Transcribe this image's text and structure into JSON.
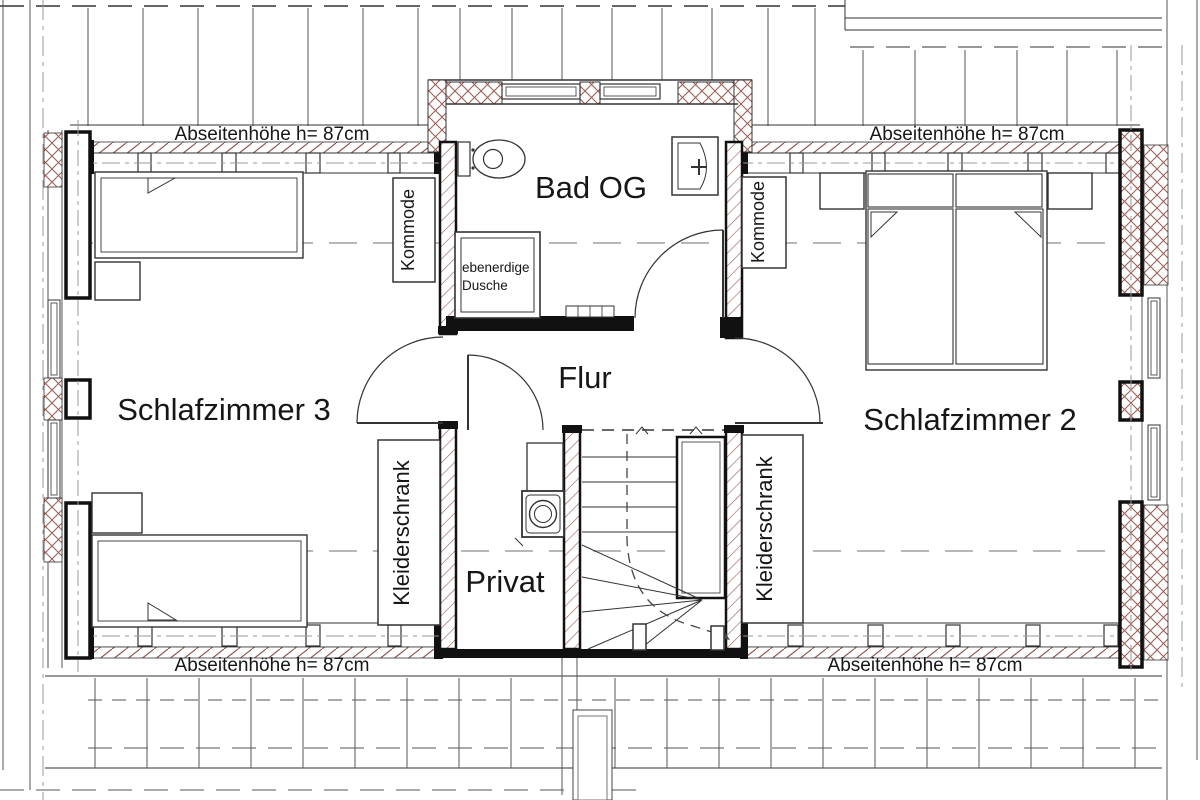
{
  "floorplan": {
    "rooms": {
      "schlafzimmer3": "Schlafzimmer 3",
      "schlafzimmer2": "Schlafzimmer 2",
      "bad": "Bad OG",
      "flur": "Flur",
      "privat": "Privat"
    },
    "furniture": {
      "kommode": "Kommode",
      "kleiderschrank": "Kleiderschrank",
      "shower_line1": "ebenerdige",
      "shower_line2": "Dusche"
    },
    "annotations": {
      "knee_wall_height": "Abseitenhöhe h= 87cm"
    },
    "colors": {
      "wall": "#111111",
      "line": "#333333",
      "hatch_brown": "#9a5a50",
      "centerline_gray": "#b8b8b8"
    }
  }
}
